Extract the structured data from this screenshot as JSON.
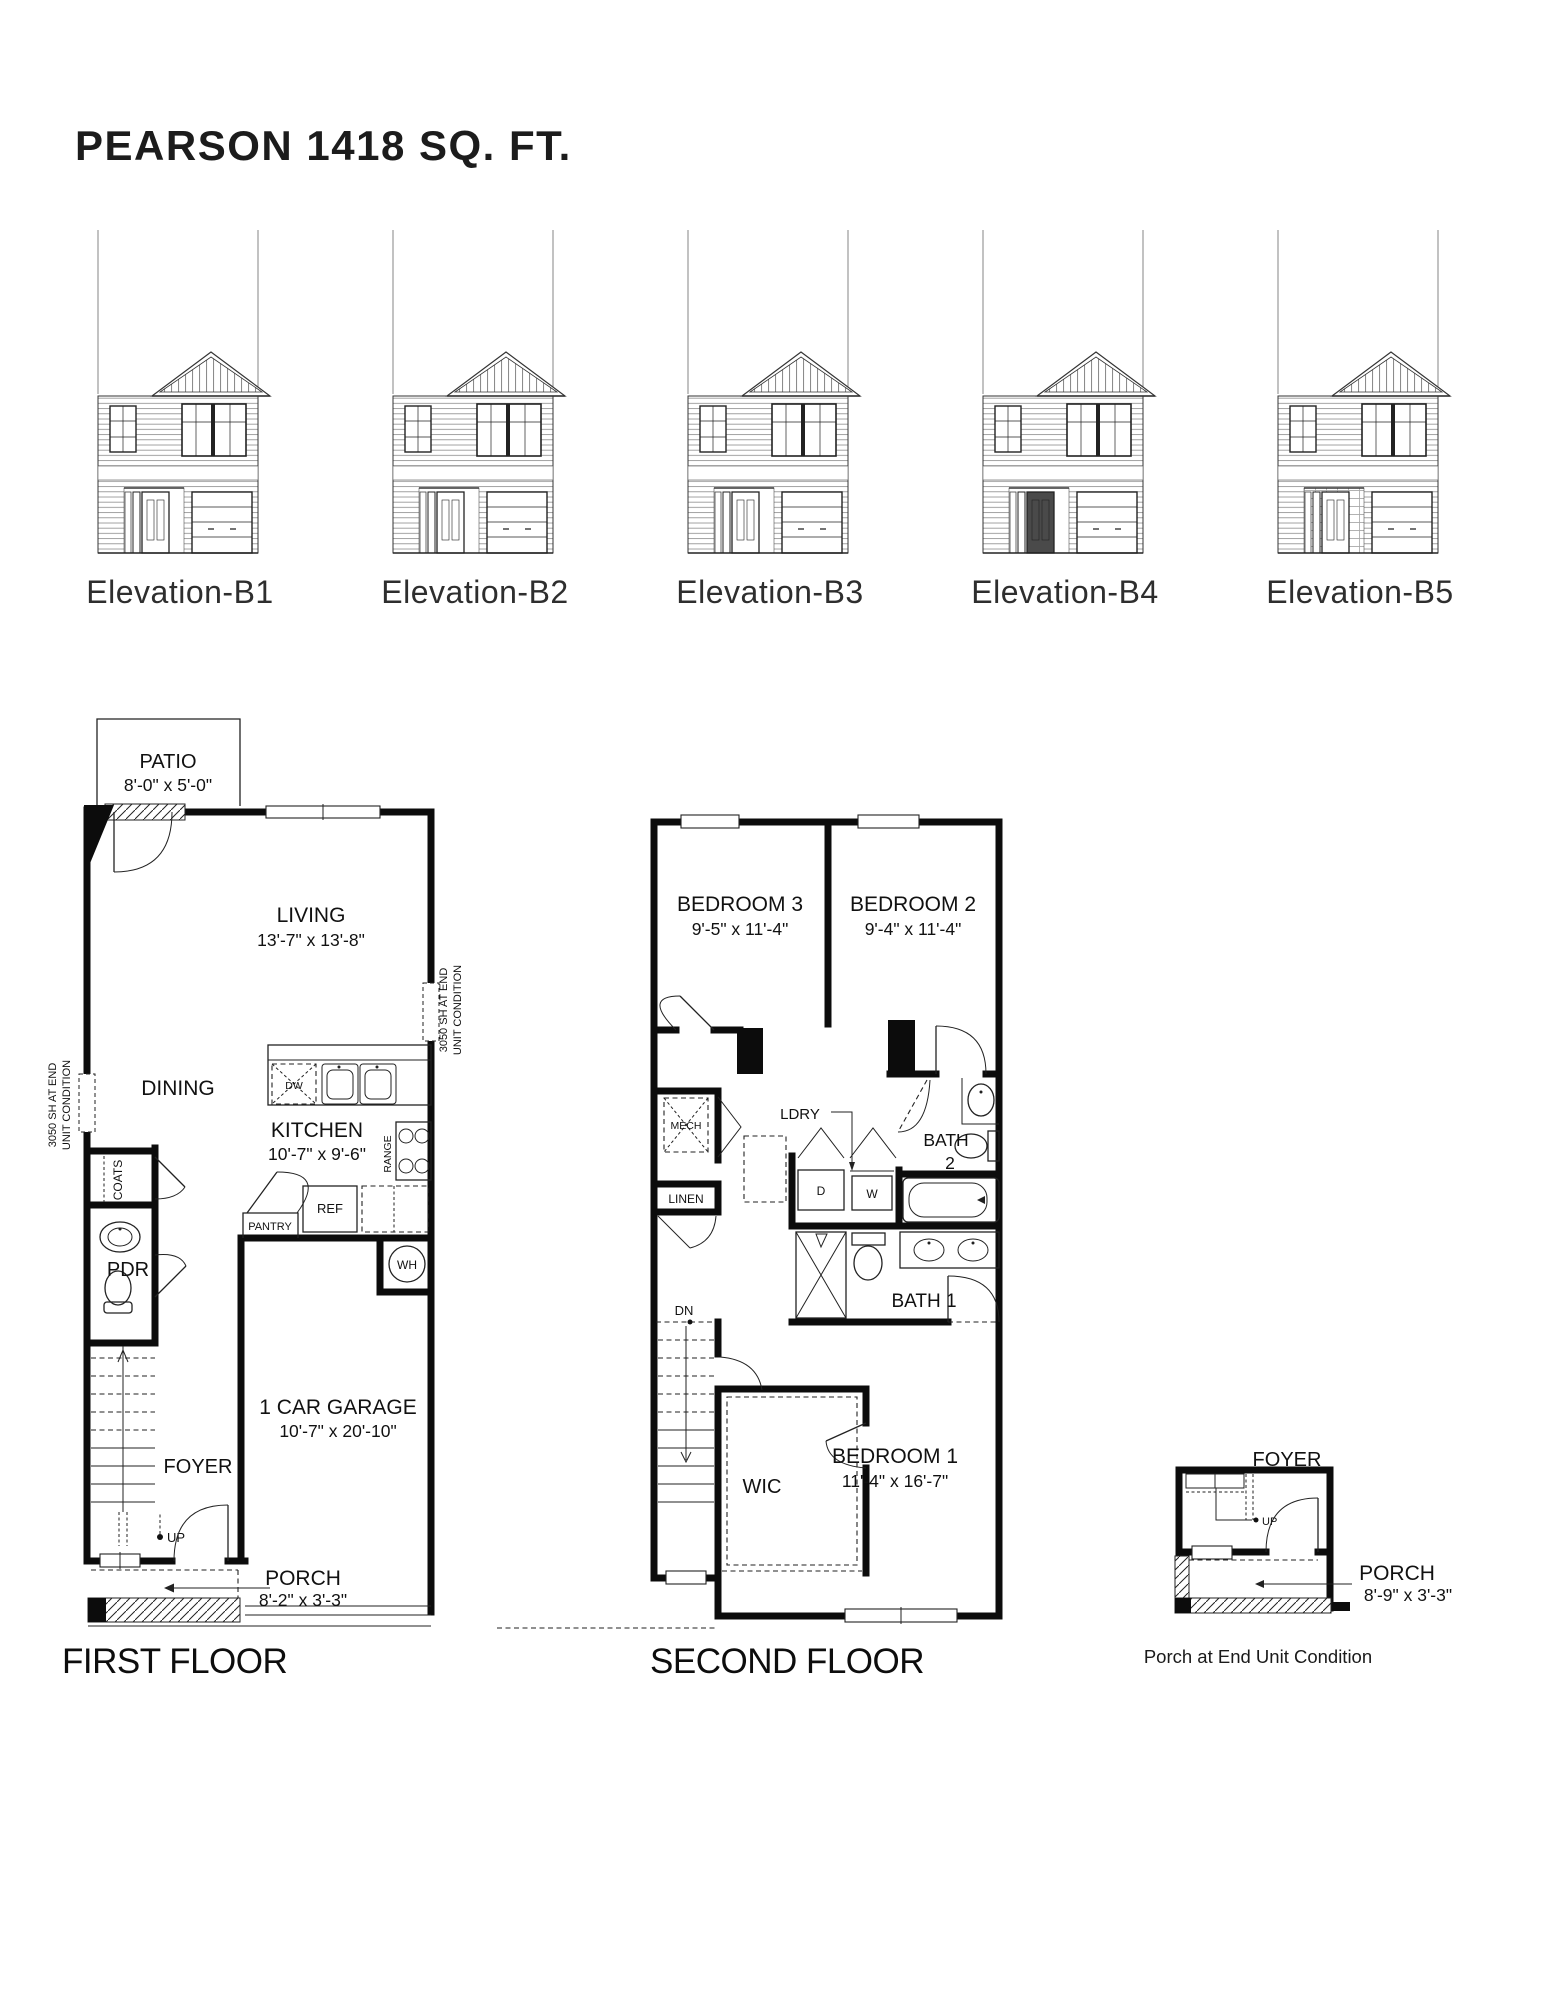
{
  "page": {
    "title": "PEARSON 1418 SQ. FT."
  },
  "elevations": [
    {
      "label": "Elevation-B1"
    },
    {
      "label": "Elevation-B2"
    },
    {
      "label": "Elevation-B3"
    },
    {
      "label": "Elevation-B4"
    },
    {
      "label": "Elevation-B5"
    }
  ],
  "first_floor": {
    "caption": "FIRST FLOOR",
    "patio_name": "PATIO",
    "patio_dims": "8'-0\" x 5'-0\"",
    "living_name": "LIVING",
    "living_dims": "13'-7\" x 13'-8\"",
    "dining": "DINING",
    "kitchen_name": "KITCHEN",
    "kitchen_dims": "10'-7\" x 9'-6\"",
    "coats": "COATS",
    "pdr": "PDR",
    "pantry": "PANTRY",
    "ref": "REF",
    "range": "RANGE",
    "dw": "DW",
    "wh": "WH",
    "garage_name": "1 CAR GARAGE",
    "garage_dims": "10'-7\" x 20'-10\"",
    "foyer": "FOYER",
    "up": "UP",
    "porch_name": "PORCH",
    "porch_dims": "8'-2\" x 3'-3\"",
    "note_line1": "3050 SH AT END",
    "note_line2": "UNIT CONDITION"
  },
  "second_floor": {
    "caption": "SECOND FLOOR",
    "bedroom3_name": "BEDROOM 3",
    "bedroom3_dims": "9'-5\" x 11'-4\"",
    "bedroom2_name": "BEDROOM 2",
    "bedroom2_dims": "9'-4\" x 11'-4\"",
    "mech": "MECH",
    "ldry": "LDRY",
    "linen": "LINEN",
    "bath2_line1": "BATH",
    "bath2_line2": "2",
    "d": "D",
    "w": "W",
    "bath1": "BATH 1",
    "dn": "DN",
    "wic": "WIC",
    "bedroom1_name": "BEDROOM 1",
    "bedroom1_dims": "11'-4\" x 16'-7\""
  },
  "porch_detail": {
    "foyer": "FOYER",
    "up": "UP",
    "porch_name": "PORCH",
    "porch_dims": "8'-9\" x 3'-3\"",
    "caption": "Porch at End Unit Condition"
  }
}
